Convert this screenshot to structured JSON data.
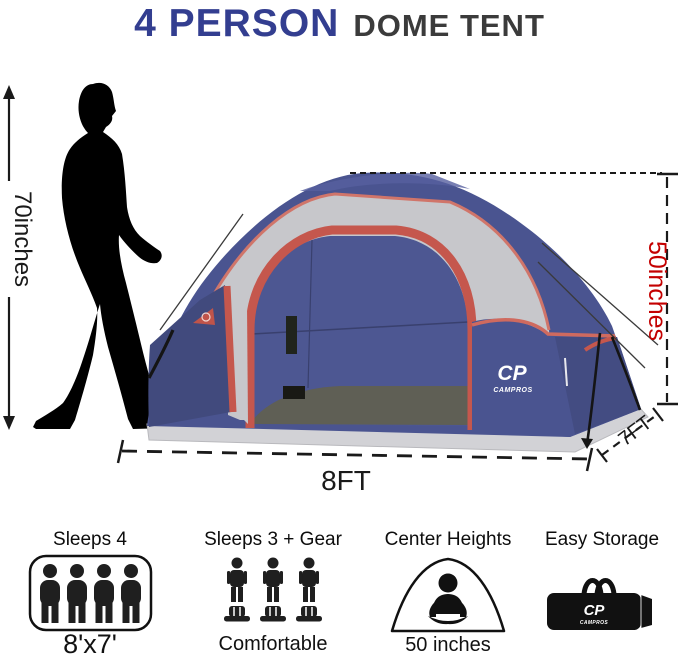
{
  "title": {
    "highlight": "4 PERSON",
    "rest": "DOME TENT"
  },
  "tent": {
    "brand": "CP",
    "brand_sub": "CAMPROS"
  },
  "measurements": {
    "person_height": {
      "label": "70inches",
      "color": "#1a1a1a"
    },
    "tent_height": {
      "label": "50inches",
      "color": "#c40000"
    },
    "tent_width": {
      "label": "8FT"
    },
    "tent_depth": {
      "label": "7FT"
    }
  },
  "features": [
    {
      "title": "Sleeps 4",
      "caption": "8'x7'",
      "icon": "four-person-icon"
    },
    {
      "title": "Sleeps 3 + Gear",
      "caption": "Comfortable",
      "icon": "three-person-gear-icon"
    },
    {
      "title": "Center Heights",
      "caption": "50 inches",
      "icon": "tent-sitting-person-icon"
    },
    {
      "title": "Easy Storage",
      "caption": "",
      "icon": "carry-bag-icon"
    }
  ],
  "icons": [
    "walking-man-silhouette",
    "dome-tent-illustration",
    "four-person-icon",
    "three-person-gear-icon",
    "tent-sitting-person-icon",
    "carry-bag-icon"
  ],
  "colors": {
    "brand_blue": "#333e90",
    "heading_gray": "#3b3b3b",
    "dimension_red": "#c40000",
    "dimension_black": "#1a1a1a",
    "tent_navy": "#4a5490",
    "tent_navy_dark": "#414a7d",
    "tent_trim_red": "#c5574d",
    "tent_inner_gray": "#c7c7cb",
    "tent_floor": "#5f5f55",
    "tent_skirt_gray": "#d2d2d6"
  }
}
